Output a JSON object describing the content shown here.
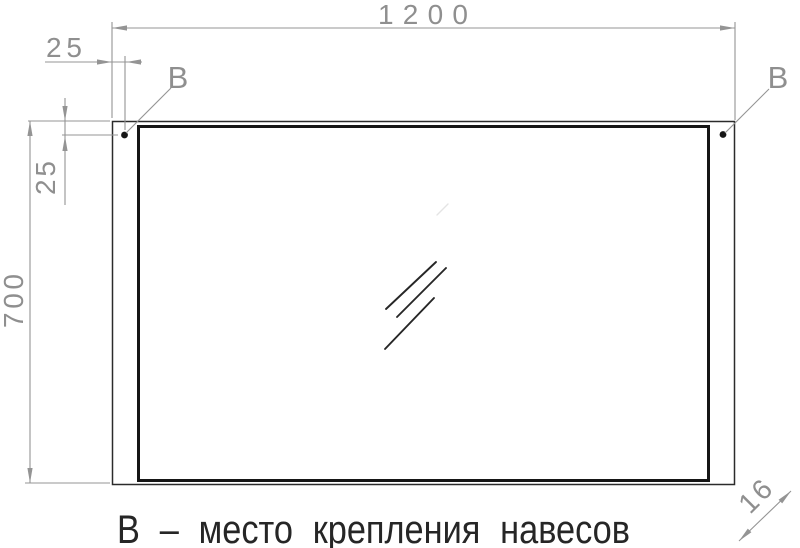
{
  "drawing": {
    "dimensions": {
      "overall_width": "1200",
      "overall_height": "700",
      "mount_offset_horizontal": "25",
      "mount_offset_vertical": "25",
      "thickness": "16"
    },
    "mount_labels": {
      "left": "В",
      "right": "В"
    },
    "caption": "В – место крепления навесов",
    "colors": {
      "outline_black": "#161616",
      "dimension_gray": "#949494",
      "caption_color": "#262626"
    }
  }
}
